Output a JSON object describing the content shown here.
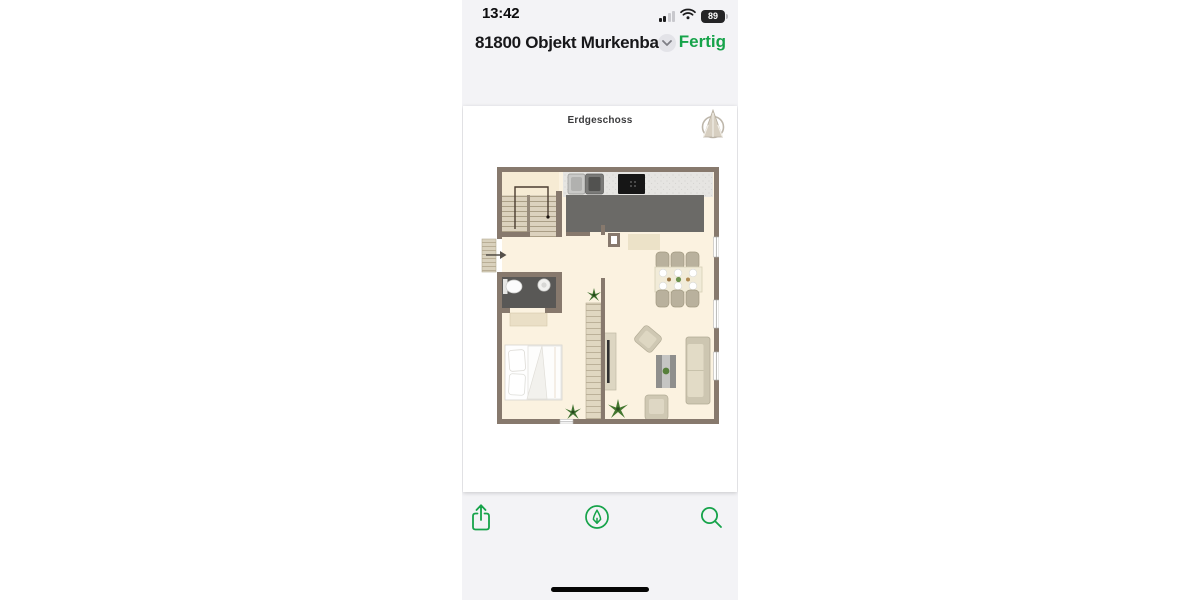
{
  "colors": {
    "accent_green": "#16a34a",
    "phone_background": "#f3f3f6",
    "page_background": "#ffffff",
    "text_primary": "#17171a",
    "plan_wall": "#87796d",
    "plan_floor": "#fbf2e0",
    "plan_island": "#6b6a67",
    "plan_bathroom_floor": "#595856"
  },
  "status_bar": {
    "time": "13:42",
    "battery_percent": "89",
    "icons": {
      "signal": "cellular-signal-bars",
      "wifi": "wifi-waves",
      "battery": "battery-with-percent"
    }
  },
  "nav_bar": {
    "title": "81800  Objekt Murkenba...",
    "chevron_icon": "chevron-down",
    "done_label": "Fertig"
  },
  "document_page": {
    "title": "Erdgeschoss",
    "logo_icon": "architect-compass-logo",
    "floor_plan": {
      "type": "floor-plan-drawing",
      "features": [
        "staircase",
        "entrance-door-arrow",
        "doormat",
        "kitchen-counter",
        "kitchen-sink",
        "cooktop",
        "kitchen-island",
        "dining-table-with-6-chairs",
        "bathroom",
        "toilet",
        "washbasin",
        "bath-mat",
        "bed",
        "wardrobe",
        "tv-sideboard",
        "sofa",
        "armchair",
        "armchair",
        "coffee-table",
        "plants",
        "windows"
      ]
    }
  },
  "toolbar": {
    "share_icon": "share-square-arrow-up",
    "markup_icon": "markup-pen-in-circle",
    "search_icon": "magnifying-glass"
  }
}
